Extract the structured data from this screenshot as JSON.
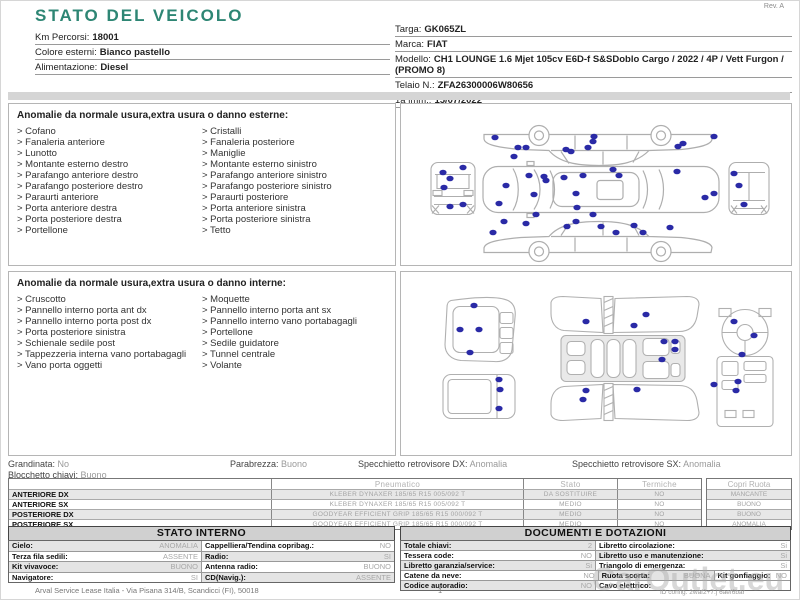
{
  "meta": {
    "rev": "Rev. A",
    "footer": "Arval Service Lease Italia - Via Pisana 314/B, Scandicci (FI), 50018",
    "page_number": "1",
    "watermark": "CarOutlet.eu",
    "id_text": "ID config. 2waf2+7.j 6aef6bar"
  },
  "colors": {
    "title_teal": "#2e8674",
    "dot_blue": "#2a2aa6"
  },
  "bullet": ">",
  "header": {
    "title": "STATO DEL VEICOLO",
    "left_fields": [
      {
        "label": "Km Percorsi:",
        "value": "18001"
      },
      {
        "label": "Colore esterni:",
        "value": "Bianco pastello"
      },
      {
        "label": "Alimentazione:",
        "value": "Diesel"
      }
    ],
    "right_fields": [
      {
        "label": "Targa:",
        "value": "GK065ZL"
      },
      {
        "label": "Marca:",
        "value": "FIAT"
      },
      {
        "label": "Modello:",
        "value": "CH1 LOUNGE 1.6 Mjet 105cv E6D-f S&SDoblo Cargo / 2022 / 4P / Vett Furgon / (PROMO 8)"
      },
      {
        "label": "Telaio N.:",
        "value": "ZFA26300006W80656"
      },
      {
        "label": "1a imm.:",
        "value": "15/07/2022"
      }
    ]
  },
  "external": {
    "title": "Anomalie da normale usura,extra usura o danno esterne:",
    "left_items": [
      "Cofano",
      "Fanaleria anteriore",
      "Lunotto",
      "Montante esterno destro",
      "Parafango anteriore destro",
      "Parafango posteriore destro",
      "Paraurti anteriore",
      "Porta anteriore destra",
      "Porta posteriore destra",
      "Portellone"
    ],
    "right_items": [
      "Cristalli",
      "Fanaleria posteriore",
      "Maniglie",
      "Montante esterno sinistro",
      "Parafango anteriore sinistro",
      "Parafango posteriore sinistro",
      "Paraurti posteriore",
      "Porta anteriore sinistra",
      "Porta posteriore sinistra",
      "Tetto"
    ],
    "dots": [
      [
        94,
        33
      ],
      [
        117,
        43
      ],
      [
        125,
        43
      ],
      [
        113,
        52
      ],
      [
        165,
        45
      ],
      [
        170,
        47
      ],
      [
        187,
        43
      ],
      [
        192,
        37
      ],
      [
        193,
        32
      ],
      [
        277,
        42
      ],
      [
        282,
        39
      ],
      [
        313,
        32
      ],
      [
        105,
        81
      ],
      [
        98,
        99
      ],
      [
        128,
        71
      ],
      [
        133,
        90
      ],
      [
        143,
        72
      ],
      [
        145,
        76
      ],
      [
        163,
        73
      ],
      [
        175,
        89
      ],
      [
        182,
        71
      ],
      [
        176,
        103
      ],
      [
        212,
        65
      ],
      [
        218,
        71
      ],
      [
        276,
        67
      ],
      [
        304,
        93
      ],
      [
        313,
        89
      ],
      [
        42,
        68
      ],
      [
        49,
        74
      ],
      [
        62,
        63
      ],
      [
        43,
        83
      ],
      [
        49,
        102
      ],
      [
        62,
        100
      ],
      [
        333,
        69
      ],
      [
        338,
        81
      ],
      [
        343,
        100
      ],
      [
        92,
        128
      ],
      [
        103,
        117
      ],
      [
        125,
        119
      ],
      [
        135,
        110
      ],
      [
        166,
        122
      ],
      [
        175,
        117
      ],
      [
        192,
        110
      ],
      [
        200,
        122
      ],
      [
        215,
        128
      ],
      [
        233,
        121
      ],
      [
        242,
        128
      ],
      [
        269,
        123
      ]
    ]
  },
  "internal": {
    "title": "Anomalie da normale usura,extra usura o danno interne:",
    "left_items": [
      "Cruscotto",
      "Pannello interno porta ant dx",
      "Pannello interno porta post dx",
      "Porta posteriore sinistra",
      "Schienale sedile post",
      "Tappezzeria interna vano portabagagli",
      "Vano porta oggetti"
    ],
    "right_items": [
      "Moquette",
      "Pannello interno porta ant sx",
      "Pannello interno vano portabagagli",
      "Portellone",
      "Sedile guidatore",
      "Tunnel centrale",
      "Volante"
    ],
    "dots": [
      [
        73,
        33
      ],
      [
        59,
        57
      ],
      [
        78,
        57
      ],
      [
        69,
        80
      ],
      [
        98,
        107
      ],
      [
        99,
        117
      ],
      [
        98,
        136
      ],
      [
        185,
        49
      ],
      [
        245,
        42
      ],
      [
        233,
        53
      ],
      [
        263,
        69
      ],
      [
        274,
        69
      ],
      [
        274,
        77
      ],
      [
        261,
        87
      ],
      [
        185,
        118
      ],
      [
        236,
        117
      ],
      [
        182,
        127
      ],
      [
        333,
        49
      ],
      [
        353,
        63
      ],
      [
        341,
        82
      ],
      [
        313,
        112
      ],
      [
        337,
        109
      ],
      [
        335,
        118
      ]
    ]
  },
  "status": [
    {
      "label": "Grandinata:",
      "value": "No"
    },
    {
      "label": "Parabrezza:",
      "value": "Buono"
    },
    {
      "label": "Specchietto retrovisore DX:",
      "value": "Anomalia"
    },
    {
      "label": "Specchietto retrovisore SX:",
      "value": "Anomalia"
    },
    {
      "label": "Blocchetto chiavi:",
      "value": "Buono"
    }
  ],
  "tyres": {
    "col_headers": [
      "Pneumatico",
      "Stato",
      "Termiche"
    ],
    "copri_header": "Copri Ruota",
    "rows": [
      {
        "position": "ANTERIORE DX",
        "tyre": "KLEBER DYNAXER  185/65 R15 005/092 T",
        "state": "DA SOSTITUIRE",
        "thermal": "NO",
        "cover": "MANCANTE"
      },
      {
        "position": "ANTERIORE SX",
        "tyre": "KLEBER DYNAXER  185/65 R15 005/092 T",
        "state": "MEDIO",
        "thermal": "NO",
        "cover": "BUONO"
      },
      {
        "position": "POSTERIORE DX",
        "tyre": "GOODYEAR EFFICIENT GRIP  185/65 R15 000/092 T",
        "state": "MEDIO",
        "thermal": "NO",
        "cover": "BUONO"
      },
      {
        "position": "POSTERIORE SX",
        "tyre": "GOODYEAR EFFICIENT GRIP  185/65 R15 000/092 T",
        "state": "MEDIO",
        "thermal": "NO",
        "cover": "ANOMALIA"
      }
    ]
  },
  "stato_interno": {
    "title": "STATO INTERNO",
    "rows": [
      [
        {
          "label": "Cielo:",
          "value": "ANOMALIA"
        },
        {
          "label": "Cappelliera/Tendina copribag.:",
          "value": "NO"
        }
      ],
      [
        {
          "label": "Terza fila sedili:",
          "value": "ASSENTE"
        },
        {
          "label": "Radio:",
          "value": "SI"
        }
      ],
      [
        {
          "label": "Kit vivavoce:",
          "value": "BUONO"
        },
        {
          "label": "Antenna radio:",
          "value": "BUONO"
        }
      ],
      [
        {
          "label": "Navigatore:",
          "value": "SI"
        },
        {
          "label": "CD(Navig.):",
          "value": "ASSENTE"
        }
      ]
    ]
  },
  "documenti": {
    "title": "DOCUMENTI E DOTAZIONI",
    "rows": [
      [
        {
          "label": "Totale chiavi:",
          "value": "2"
        },
        {
          "label": "Libretto circolazione:",
          "value": "Si"
        }
      ],
      [
        {
          "label": "Tessera code:",
          "value": "NO"
        },
        {
          "label": "Libretto uso e manutenzione:",
          "value": "Si"
        }
      ],
      [
        {
          "label": "Libretto garanzia/service:",
          "value": "Si"
        },
        {
          "label": "Triangolo di emergenza:",
          "value": "Si"
        }
      ],
      [
        {
          "label": "Catene da neve:",
          "value": "NO"
        },
        {
          "label": "Ruota scorta:",
          "value": "BUONA"
        },
        {
          "label": "Kit gonfiaggio:",
          "value": "NO"
        }
      ],
      [
        {
          "label": "Codice autoradio:",
          "value": "NO"
        },
        {
          "label": "Cavo elettrico:",
          "value": ""
        }
      ]
    ]
  }
}
